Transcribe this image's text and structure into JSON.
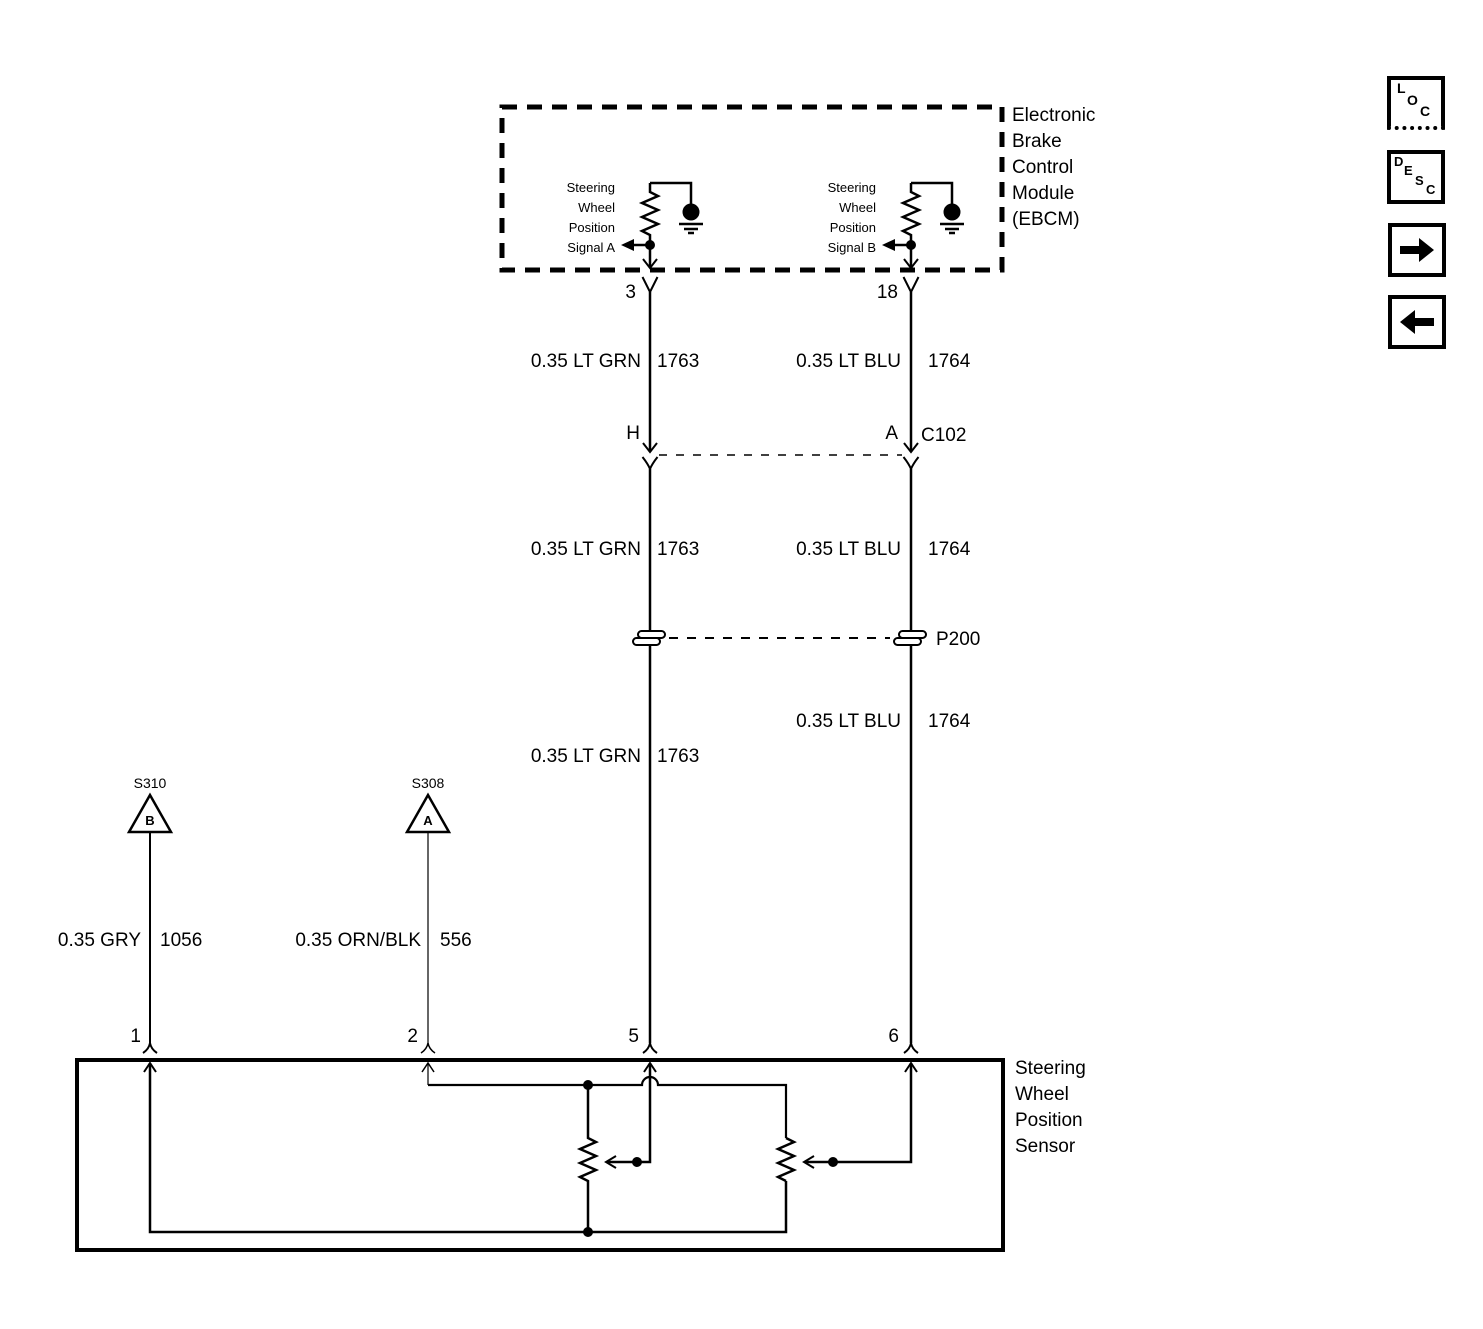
{
  "ebcm": {
    "title": "Electronic\nBrake\nControl\nModule\n(EBCM)",
    "signal_a_label": "Steering\nWheel\nPosition\nSignal A",
    "signal_b_label": "Steering\nWheel\nPosition\nSignal B",
    "pin_3": "3",
    "pin_18": "18"
  },
  "connector_c102": {
    "pin_h": "H",
    "pin_a": "A",
    "label": "C102"
  },
  "passthrough_p200": {
    "label": "P200"
  },
  "wires": {
    "ebcm_c102_left": {
      "color": "0.35 LT GRN",
      "circuit": "1763"
    },
    "ebcm_c102_right": {
      "color": "0.35 LT BLU",
      "circuit": "1764"
    },
    "c102_p200_left": {
      "color": "0.35 LT GRN",
      "circuit": "1763"
    },
    "c102_p200_right": {
      "color": "0.35 LT BLU",
      "circuit": "1764"
    },
    "p200_sensor_left": {
      "color": "0.35 LT GRN",
      "circuit": "1763"
    },
    "p200_sensor_right": {
      "color": "0.35 LT BLU",
      "circuit": "1764"
    },
    "splice_gry": {
      "color": "0.35 GRY",
      "circuit": "1056"
    },
    "splice_orn": {
      "color": "0.35 ORN/BLK",
      "circuit": "556"
    }
  },
  "splices": {
    "s310": {
      "label": "S310",
      "letter": "B"
    },
    "s308": {
      "label": "S308",
      "letter": "A"
    }
  },
  "sensor": {
    "title": "Steering\nWheel\nPosition\nSensor",
    "pin_1": "1",
    "pin_2": "2",
    "pin_5": "5",
    "pin_6": "6"
  },
  "toolbar": {
    "loc_letters": [
      "L",
      "O",
      "C"
    ],
    "desc_letters": [
      "D",
      "E",
      "S",
      "C"
    ]
  },
  "colors": {
    "line": "#000000",
    "background": "#ffffff"
  }
}
